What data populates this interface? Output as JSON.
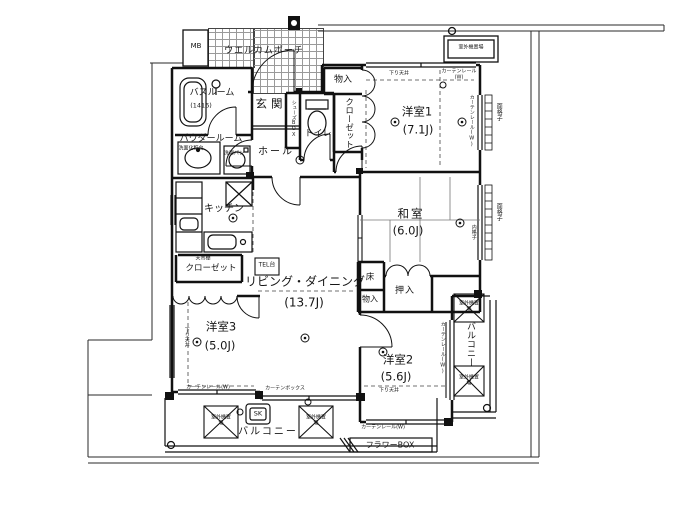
{
  "rooms": {
    "yoshitsu1": {
      "name": "洋室1",
      "size": "(7.1J)"
    },
    "washitsu": {
      "name": "和室",
      "size": "(6.0J)"
    },
    "yoshitsu2": {
      "name": "洋室2",
      "size": "(5.6J)"
    },
    "yoshitsu3": {
      "name": "洋室3",
      "size": "(5.0J)"
    },
    "living": {
      "name": "リビング・ダイニング",
      "size": "(13.7J)"
    },
    "kitchen": {
      "name": "キッチン"
    },
    "genkan": {
      "name": "玄関"
    },
    "hall": {
      "name": "ホール"
    },
    "toilet": {
      "name": "トイレ"
    },
    "bathroom": {
      "name": "バスルーム",
      "size": "(1416)"
    },
    "powder_room": {
      "name": "パウダールーム"
    },
    "welcome_porch": {
      "name": "ウエルカムポーチ"
    },
    "balcony": {
      "name": "バルコニー"
    }
  },
  "storage": {
    "monoire": "物入",
    "closet": "クローゼット",
    "closet_shelf_note": "天吊棚",
    "oshiire": "押入",
    "toko": "床",
    "shoes_box": "シューズBOX"
  },
  "fixtures": {
    "mb": "MB",
    "tel_stand": "TEL台",
    "slop_sink": "SK",
    "flower_box": "フラワーBOX",
    "vanity": "洗面化粧台",
    "laundry_pan": "洗濯パン",
    "outdoor_unit": "室外機置場"
  },
  "notes": {
    "curtain_rail": "カーテンレール(W)",
    "curtain_box": "カーテンボックス",
    "lowered_ceiling": "下り天井",
    "window_grille": "面格子",
    "inner_grille": "内格子"
  },
  "colors": {
    "line": "#1b1b1b",
    "background": "#ffffff"
  }
}
